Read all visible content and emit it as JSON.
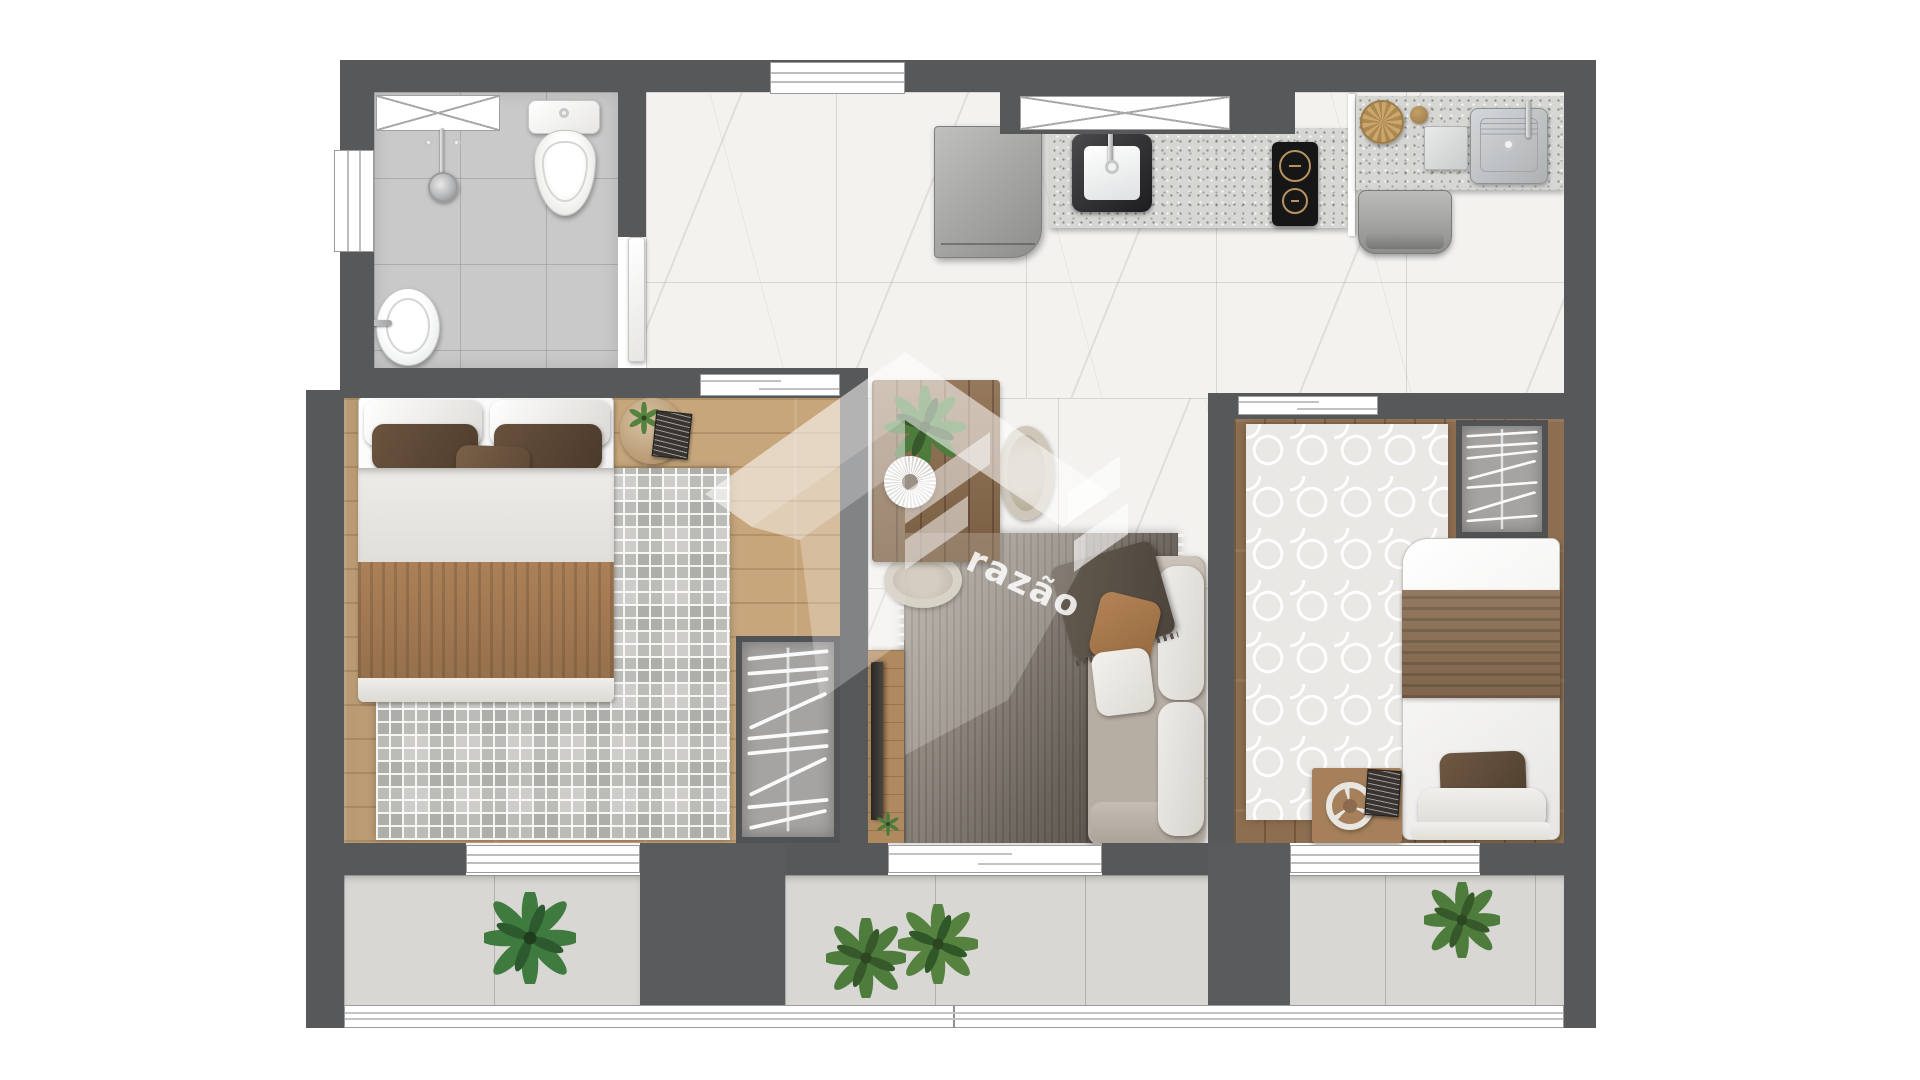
{
  "scene": {
    "type": "architectural-floor-plan-render",
    "view": "top-down",
    "watermark": {
      "brand_text": "razão"
    }
  },
  "palette": {
    "wall": "#57585a",
    "marble_floor": "#f3f2ef",
    "bathroom_tile": "#c9c9c9",
    "wood_light": "#c7a67c",
    "wood_dark": "#8d6e50",
    "granite_counter": "#d6d6d3",
    "rug_bedroom1": "#cecdc9",
    "rug_bedroom2": "#eae8e4",
    "rug_living_dark": "#524c46",
    "balcony_tile": "#d8d7d4",
    "fixture_white": "#f2f1ee",
    "fabric_brown": "#a57a52",
    "pillow_dark_brown": "#5c4836",
    "sofa_fabric": "#b6ada3",
    "plant_green": "#4d7c3c",
    "cooktop_black": "#161616"
  },
  "rooms": {
    "bathroom": {
      "fixtures": [
        "ventilation-shaft",
        "shower",
        "toilet",
        "washbasin",
        "swing-door",
        "wall-window"
      ]
    },
    "kitchen": {
      "fixtures": [
        "refrigerator",
        "granite-counter",
        "inset-sink",
        "faucet",
        "two-burner-cooktop",
        "crossed-window",
        "top-window"
      ]
    },
    "laundry": {
      "fixtures": [
        "granite-counter",
        "wicker-basket",
        "jar",
        "soap-box",
        "laundry-tank",
        "washing-machine",
        "divider-panel"
      ]
    },
    "dining": {
      "fixtures": [
        "wood-table",
        "sunburst-plate",
        "table-plant",
        "cane-chair-east",
        "cane-chair-south"
      ]
    },
    "living": {
      "fixtures": [
        "tv-console",
        "tv",
        "console-plant",
        "area-rug",
        "sofa",
        "throw-blanket",
        "brown-pillow",
        "white-pillow",
        "balcony-sliding-door"
      ]
    },
    "bedroom_1": {
      "fixtures": [
        "double-bed",
        "white-pillows",
        "brown-pillows",
        "sheet",
        "brown-blanket",
        "round-nightstand",
        "nightstand-plant",
        "books",
        "greek-key-rug",
        "open-wardrobe",
        "sliding-door",
        "balcony-window"
      ]
    },
    "bedroom_2": {
      "fixtures": [
        "single-bed",
        "brown-pillow",
        "brown-blanket",
        "trellis-rug",
        "open-wardrobe",
        "desk",
        "wall-clock",
        "book",
        "sliding-door",
        "balcony-window"
      ]
    },
    "balcony": {
      "fixtures": [
        "plant-left",
        "plant-center-1",
        "plant-center-2",
        "plant-right",
        "glass-railing"
      ]
    }
  }
}
